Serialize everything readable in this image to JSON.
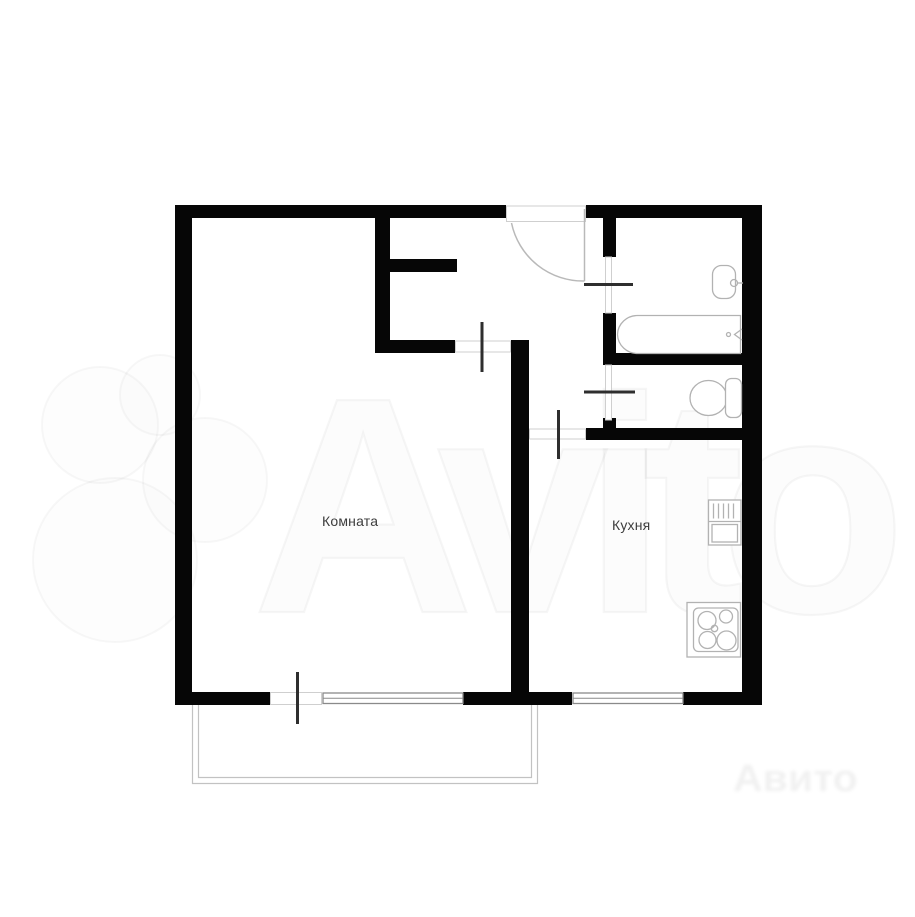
{
  "rooms": {
    "room": {
      "label": "Комната"
    },
    "kitchen": {
      "label": "Кухня"
    }
  },
  "watermark": {
    "brand": "Avito",
    "corner_text": "Авито"
  },
  "fixtures": {
    "bath_sink": "sink-icon",
    "bathtub": "bathtub-icon",
    "toilet": "toilet-icon",
    "kitchen_sink_unit": "kitchen-sink-icon",
    "stove": "stove-4-burner-icon"
  },
  "theme": {
    "bg": "#ffffff",
    "wall": "#060606",
    "door": "#2e2e2e",
    "thin": "#cfcfcf",
    "window": "#8a8a8a",
    "fixture": "#b2b2b2",
    "label": "#3d3d3d"
  }
}
